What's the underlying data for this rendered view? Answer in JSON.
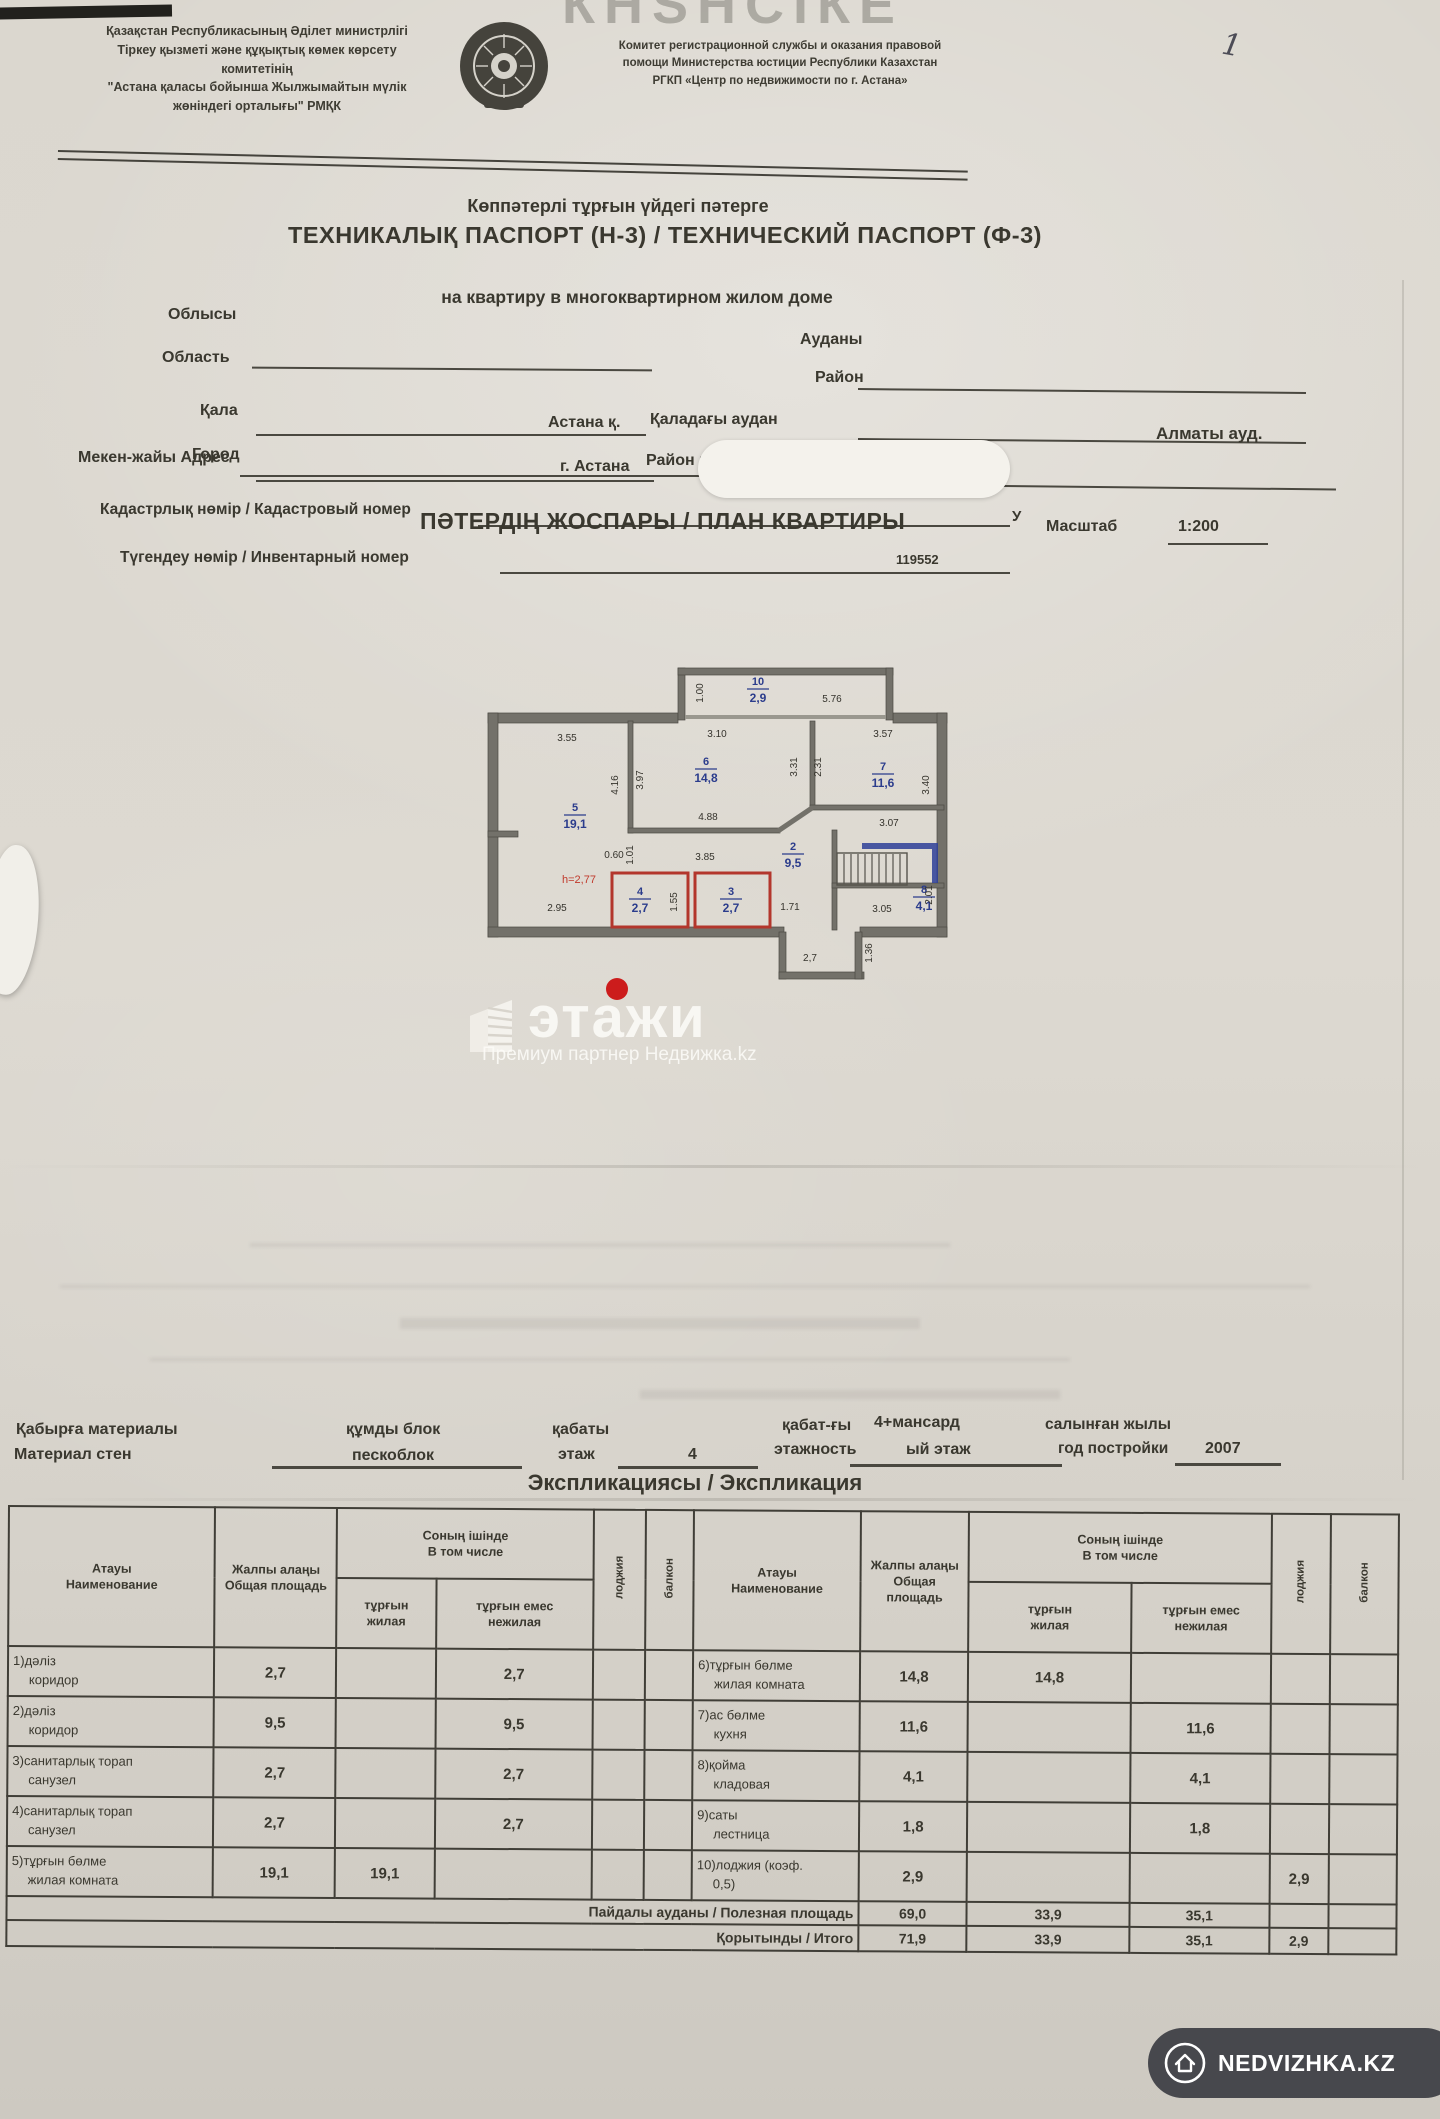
{
  "photo": {
    "page_number": "1",
    "top_watermark_fragment": "КНЅНСІКЕ"
  },
  "header": {
    "left_lines": [
      "Қазақстан Республикасының Әділет министрлігі",
      "Тіркеу қызметі және құқықтық көмек көрсету",
      "комитетінің",
      "\"Астана қаласы бойынша Жылжымайтын мүлік",
      "жөніндегі орталығы\" РМҚК"
    ],
    "right_lines": [
      "Комитет регистрационной службы и оказания правовой",
      "помощи Министерства юстиции Республики Казахстан",
      "РГКП «Центр по недвижимости по г. Астана»"
    ],
    "emblem": "kazakhstan-state-emblem"
  },
  "title": {
    "line1": "Көппәтерлі тұрғын үйдегі пәтерге",
    "line2": "ТЕХНИКАЛЫҚ ПАСПОРТ (Н-3) / ТЕХНИЧЕСКИЙ ПАСПОРТ (Ф-3)",
    "line3": "на квартиру в многоквартирном жилом доме"
  },
  "fields": {
    "oblys_kz": "Облысы",
    "oblys_ru": "Область",
    "audany_kz": "Ауданы",
    "audany_ru": "Район",
    "qala_kz": "Қала",
    "qala_ru": "Город",
    "qala_value_kz": "Астана қ.",
    "qala_value_ru": "г. Астана",
    "city_district_kz": "Қаладағы аудан",
    "city_district_ru": "Район в городе",
    "city_district_value": "Алматы ауд.",
    "address_label": "Мекен-жайы Адрес",
    "address_fragment": "У",
    "cadastre_label": "Кадастрлық нөмір / Кадастровый номер",
    "inventory_label": "Түгендеу нөмір / Инвентарный номер",
    "inventory_value": "119552"
  },
  "plan": {
    "title": "ПӘТЕРДІҢ ЖОСПАРЫ / ПЛАН КВАРТИРЫ",
    "scale_label": "Масштаб",
    "scale_value": "1:200",
    "rooms": [
      {
        "num": "10",
        "area": "2,9"
      },
      {
        "num": "5",
        "area": "19,1"
      },
      {
        "num": "6",
        "area": "14,8"
      },
      {
        "num": "7",
        "area": "11,6"
      },
      {
        "num": "2",
        "area": "9,5"
      },
      {
        "num": "4",
        "area": "2,7"
      },
      {
        "num": "3",
        "area": "2,7"
      },
      {
        "num": "8",
        "area": "4,1"
      }
    ],
    "dims": [
      "3.55",
      "3.10",
      "3.57",
      "5.76",
      "1.00",
      "4.16",
      "3.97",
      "4.88",
      "3.31",
      "2.31",
      "3.40",
      "3.07",
      "0.60",
      "1.01",
      "3.85",
      "1.55",
      "1.71",
      "2.95",
      "3.05",
      "2.01",
      "1.36",
      "2,7"
    ],
    "height_note": "h=2,77"
  },
  "watermark": {
    "brand": "этажи",
    "subtitle": "Премиум партнер Недвижка.kz"
  },
  "building": {
    "wall_label_kz": "Қабырға материалы",
    "wall_label_ru": "Материал стен",
    "wall_value_kz": "құмды блок",
    "wall_value_ru": "пескоблок",
    "floor_label_kz": "қабаты",
    "floor_label_ru": "этаж",
    "floor_value": "4",
    "storeys_label_kz": "қабат-ғы",
    "storeys_label_ru": "этажность",
    "storeys_value_line1": "4+мансард",
    "storeys_value_line2": "ый этаж",
    "year_label_kz": "салынған жылы",
    "year_label_ru": "год постройки",
    "year_value": "2007"
  },
  "exp": {
    "section_title": "Экспликациясы / Экспликация",
    "head": {
      "name_kz": "Атауы",
      "name_ru": "Наименование",
      "total_kz": "Жалпы алаңы",
      "total_ru": "Общая площадь",
      "incl_kz": "Соның ішінде",
      "incl_ru": "В том числе",
      "living_kz": "тұрғын",
      "living_ru": "жилая",
      "nonliving_kz": "тұрғын емес",
      "nonliving_ru": "нежилая",
      "loggia": "лоджия",
      "balcony": "балкон"
    },
    "rows": [
      {
        "left": {
          "kz": "1)дәліз",
          "ru": "коридор",
          "total": "2,7",
          "living": "",
          "nonliving": "2,7",
          "loggia": "",
          "balcony": ""
        },
        "right": {
          "kz": "6)тұрғын бөлме",
          "ru": "жилая комната",
          "total": "14,8",
          "living": "14,8",
          "nonliving": "",
          "loggia": "",
          "balcony": ""
        }
      },
      {
        "left": {
          "kz": "2)дәліз",
          "ru": "коридор",
          "total": "9,5",
          "living": "",
          "nonliving": "9,5",
          "loggia": "",
          "balcony": ""
        },
        "right": {
          "kz": "7)ас бөлме",
          "ru": "кухня",
          "total": "11,6",
          "living": "",
          "nonliving": "11,6",
          "loggia": "",
          "balcony": ""
        }
      },
      {
        "left": {
          "kz": "3)санитарлық торап",
          "ru": "санузел",
          "total": "2,7",
          "living": "",
          "nonliving": "2,7",
          "loggia": "",
          "balcony": ""
        },
        "right": {
          "kz": "8)қойма",
          "ru": "кладовая",
          "total": "4,1",
          "living": "",
          "nonliving": "4,1",
          "loggia": "",
          "balcony": ""
        }
      },
      {
        "left": {
          "kz": "4)санитарлық торап",
          "ru": "санузел",
          "total": "2,7",
          "living": "",
          "nonliving": "2,7",
          "loggia": "",
          "balcony": ""
        },
        "right": {
          "kz": "9)саты",
          "ru": "лестница",
          "total": "1,8",
          "living": "",
          "nonliving": "1,8",
          "loggia": "",
          "balcony": ""
        }
      },
      {
        "left": {
          "kz": "5)тұрғын бөлме",
          "ru": "жилая комната",
          "total": "19,1",
          "living": "19,1",
          "nonliving": "",
          "loggia": "",
          "balcony": ""
        },
        "right": {
          "kz": "10)лоджия (коэф.",
          "ru": "0,5)",
          "total": "2,9",
          "living": "",
          "nonliving": "",
          "loggia": "2,9",
          "balcony": ""
        }
      }
    ],
    "useful": {
      "label": "Пайдалы ауданы / Полезная площадь",
      "total": "69,0",
      "living": "33,9",
      "nonliving": "35,1",
      "loggia": "",
      "balcony": ""
    },
    "total": {
      "label": "Қорытынды / Итого",
      "total": "71,9",
      "living": "33,9",
      "nonliving": "35,1",
      "loggia": "2,9",
      "balcony": ""
    }
  },
  "badge": {
    "label": "NEDVIZHKA.KZ"
  },
  "colors": {
    "accent_red": "#c0392b",
    "accent_blue": "#2b3c8c",
    "ink": "#3a382f",
    "badge_bg": "#47484d"
  }
}
